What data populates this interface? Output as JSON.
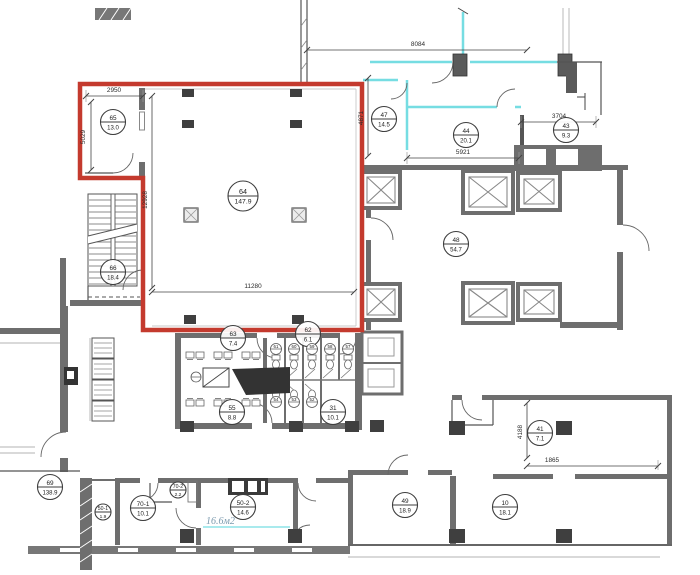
{
  "drawing": {
    "type": "floor-plan",
    "highlight_color": "#c43a2e",
    "partition_color": "#76dde2",
    "wall_color": "#6e6e6e",
    "annotation_color": "#7b9aae"
  },
  "rooms": [
    {
      "id": "65",
      "area": "13.0",
      "x": 113,
      "y": 122
    },
    {
      "id": "64",
      "area": "147.9",
      "x": 243,
      "y": 196,
      "size": "large"
    },
    {
      "id": "66",
      "area": "18.4",
      "x": 113,
      "y": 272
    },
    {
      "id": "47",
      "area": "14.5",
      "x": 384,
      "y": 119
    },
    {
      "id": "44",
      "area": "20.1",
      "x": 466,
      "y": 135
    },
    {
      "id": "43",
      "area": "9.3",
      "x": 566,
      "y": 130
    },
    {
      "id": "48",
      "area": "54.7",
      "x": 456,
      "y": 244
    },
    {
      "id": "63",
      "area": "7.4",
      "x": 233,
      "y": 338
    },
    {
      "id": "62",
      "area": "6.1",
      "x": 308,
      "y": 334
    },
    {
      "id": "55",
      "area": "8.8",
      "x": 232,
      "y": 412
    },
    {
      "id": "31",
      "area": "10.1",
      "x": 333,
      "y": 412
    },
    {
      "id": "69",
      "area": "138.9",
      "x": 50,
      "y": 487
    },
    {
      "id": "50-1",
      "area": "1.9",
      "x": 103,
      "y": 512,
      "size": "small"
    },
    {
      "id": "70-1",
      "area": "10.1",
      "x": 143,
      "y": 508
    },
    {
      "id": "70-2",
      "area": "2.2",
      "x": 178,
      "y": 490,
      "size": "small"
    },
    {
      "id": "50-2",
      "area": "14.6",
      "x": 243,
      "y": 507
    },
    {
      "id": "49",
      "area": "18.9",
      "x": 405,
      "y": 505
    },
    {
      "id": "10",
      "area": "18.1",
      "x": 505,
      "y": 507
    },
    {
      "id": "41",
      "area": "7.1",
      "x": 540,
      "y": 433
    }
  ],
  "stall_labels": [
    {
      "id": "61",
      "x": 276,
      "y": 349
    },
    {
      "id": "60",
      "x": 294,
      "y": 349
    },
    {
      "id": "59",
      "x": 312,
      "y": 349
    },
    {
      "id": "58",
      "x": 330,
      "y": 349
    },
    {
      "id": "57",
      "x": 348,
      "y": 349
    },
    {
      "id": "54",
      "x": 276,
      "y": 402
    },
    {
      "id": "53",
      "x": 294,
      "y": 402
    },
    {
      "id": "52",
      "x": 312,
      "y": 402
    }
  ],
  "dimensions": [
    {
      "value": "2950",
      "x": 114,
      "y": 92,
      "orient": "h"
    },
    {
      "value": "5029",
      "x": 85,
      "y": 137,
      "orient": "v"
    },
    {
      "value": "12928",
      "x": 147,
      "y": 200,
      "orient": "v"
    },
    {
      "value": "11280",
      "x": 253,
      "y": 288,
      "orient": "h"
    },
    {
      "value": "8084",
      "x": 418,
      "y": 46,
      "orient": "h"
    },
    {
      "value": "4871",
      "x": 363,
      "y": 118,
      "orient": "v"
    },
    {
      "value": "5921",
      "x": 463,
      "y": 154,
      "orient": "h"
    },
    {
      "value": "3704",
      "x": 559,
      "y": 118,
      "orient": "h"
    },
    {
      "value": "4188",
      "x": 522,
      "y": 432,
      "orient": "v"
    },
    {
      "value": "1865",
      "x": 552,
      "y": 462,
      "orient": "h"
    }
  ],
  "annotations": [
    {
      "text": "16.6м2",
      "x": 206,
      "y": 524
    }
  ]
}
